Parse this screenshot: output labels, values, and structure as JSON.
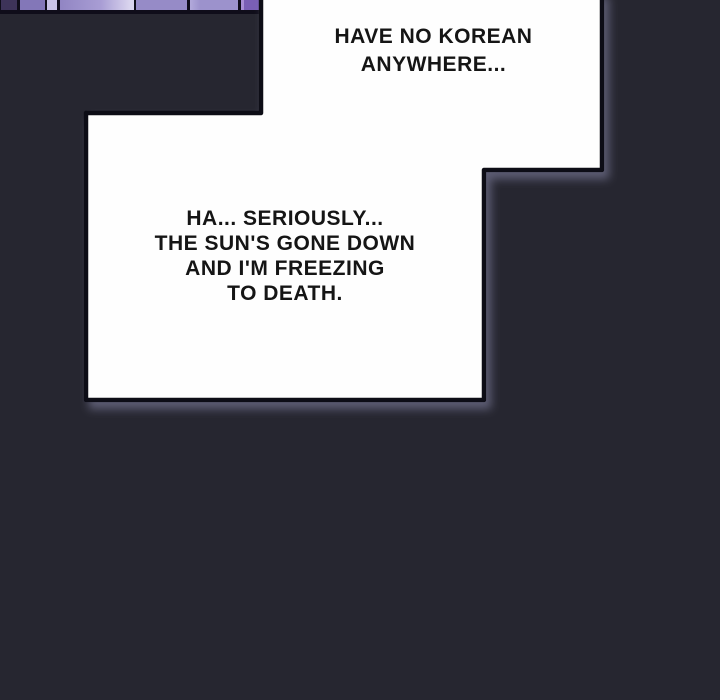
{
  "scene": {
    "background_color": "#262630",
    "bubble_fill": "#fefefe",
    "bubble_border_color": "#0d0d12",
    "shadow_color": "#9090b4",
    "text_color": "#151515"
  },
  "top_strip": {
    "description": "cropped purple comic artwork: row of panel segments",
    "segments": [
      {
        "color": "#3d3359",
        "style": "left:1px;width:16px;background:#3d3359"
      },
      {
        "color": "#8377b8",
        "style": "left:20px;width:25px;background:#8377b8"
      },
      {
        "color": "#c9c3e6",
        "style": "left:47px;width:10px;background:#c9c3e6"
      },
      {
        "color": "#a89dd4",
        "style": "left:60px;width:74px;background:linear-gradient(90deg,#9185c3,#a89dd4 55%,#d9d4ee 94%)"
      },
      {
        "color": "#968bc7",
        "style": "left:136px;width:51px;background:#968bc7"
      },
      {
        "color": "#9c92cc",
        "style": "left:190px;width:48px;background:linear-gradient(90deg,#b2a9db,#9c92cc 22%)"
      },
      {
        "color": "#7a5fb5",
        "style": "left:241px;width:21px;background:linear-gradient(90deg,#a98fd6 0px,#a98fd6 3px,#7a5fb5 3px)"
      }
    ]
  },
  "bubbles": [
    {
      "name": "speech-bubble-top",
      "lines": [
        "HAVE NO KOREAN",
        "ANYWHERE..."
      ]
    },
    {
      "name": "speech-bubble-main",
      "lines": [
        "HA... SERIOUSLY...",
        "THE SUN'S GONE DOWN",
        "AND I'M FREEZING",
        "TO DEATH."
      ]
    }
  ]
}
